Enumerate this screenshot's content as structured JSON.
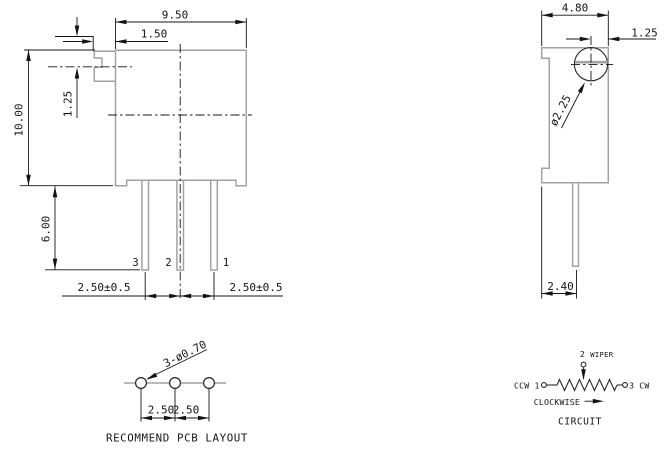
{
  "front_view": {
    "body_width": "9.50",
    "screw_boss_width": "1.50",
    "body_height": "10.00",
    "slot_offset": "1.25",
    "pin_length": "6.00",
    "pin_pitch_left": "2.50±0.5",
    "pin_pitch_right": "2.50±0.5",
    "pin_left": "3",
    "pin_middle": "2",
    "pin_right": "1"
  },
  "side_view": {
    "body_depth": "4.80",
    "screw_center_offset": "1.25",
    "screw_slot_dia": "ø2.25",
    "pin_row_offset": "2.40"
  },
  "pcb_layout": {
    "holes_note": "3-ø0.70",
    "pitch_left": "2.50",
    "pitch_right": "2.50",
    "caption": "RECOMMEND PCB LAYOUT"
  },
  "circuit": {
    "top_terminal": "2",
    "top_label": "WIPER",
    "left_label": "CCW 1",
    "right_label": "3 CW",
    "rotation_label": "CLOCKWISE",
    "caption": "CIRCUIT"
  },
  "colors": {
    "outline": "#a2a2a2",
    "ink": "#141414"
  }
}
